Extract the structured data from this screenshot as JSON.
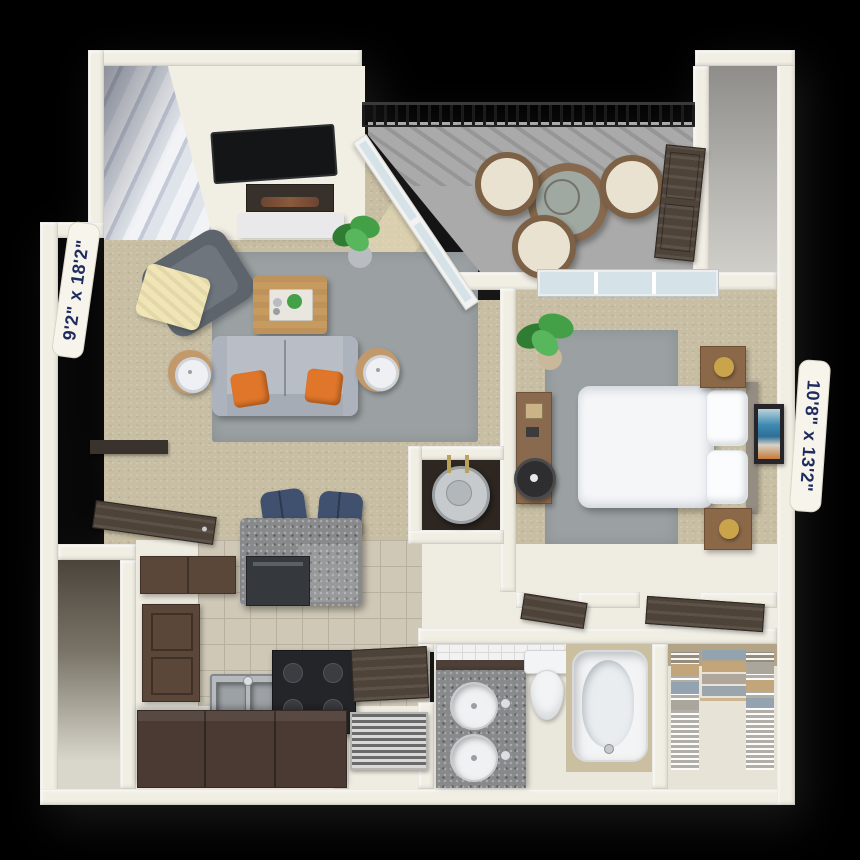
{
  "rooms": {
    "living_room": {
      "dimensions": "9'2\" x 18'2\"",
      "features": [
        "staircase",
        "tv",
        "fireplace",
        "hearth",
        "armchair",
        "throw-blanket",
        "sofa",
        "accent-pillows",
        "coffee-table",
        "serving-tray",
        "side-tables",
        "lamps",
        "area-rug",
        "potted-plant",
        "sliding-glass-door",
        "sunlight-patches"
      ]
    },
    "balcony": {
      "features": [
        "metal-railing",
        "wicker-bistro-table",
        "wicker-chairs",
        "storage-closet",
        "storage-doors"
      ]
    },
    "bedroom": {
      "dimensions": "10'8\" x 13'2\"",
      "features": [
        "bed",
        "white-duvet",
        "pillows",
        "headboard",
        "nightstands",
        "gold-lamps",
        "desk",
        "desk-chair",
        "area-rug",
        "potted-plant",
        "wall-art",
        "window",
        "open-doors"
      ]
    },
    "kitchen": {
      "features": [
        "breakfast-bar",
        "bar-stools",
        "dishwasher",
        "double-sink",
        "range",
        "upper-cabinet",
        "pantry-door",
        "base-counters",
        "tile-floor",
        "entry-door"
      ]
    },
    "bathroom": {
      "features": [
        "granite-double-vanity",
        "round-sinks",
        "toilet",
        "bathtub",
        "tile-wainscot",
        "open-door"
      ]
    },
    "walk_in_closet": {
      "features": [
        "wire-shelving",
        "folded-clothes"
      ]
    },
    "utility": {
      "features": [
        "water-heater",
        "laundry-closet",
        "hvac-vent-panel"
      ]
    }
  },
  "colors": {
    "background": "#000000",
    "wall": "#f1eee4",
    "wall_shade": "#dedacb",
    "carpet": "#c8bea3",
    "rug": "#9ba1a3",
    "sunlight": "#e9dfba",
    "balcony_floor": "#aaaaaa",
    "storage_floor": "#b4b3af",
    "railing": "#1b1b1b",
    "glass": "#d5e3e9",
    "window_frame": "#ededed",
    "sofa": "#b9bec6",
    "sofa_shade": "#a5acb6",
    "armchair": "#5d646c",
    "throw_blanket": "#f1e5b5",
    "pillow_accent": "#e0762a",
    "wood": "#c79a60",
    "side_table": "#c2996b",
    "lamp_white": "#eef0f3",
    "plant_green": "#43a047",
    "plant_dark": "#2e7d32",
    "plant_pot": "#b9bdc2",
    "tile": "#cfc8b7",
    "grout": "#b8b1a0",
    "granite": "#87898b",
    "granite_dark": "#5f6164",
    "stool_blue": "#3f516f",
    "cabinet_brown": "#5b463a",
    "counter_dark": "#4a3a33",
    "stove_black": "#232528",
    "steel": "#b6babd",
    "door_dark": "#4e4339",
    "bed_white": "#f5f6f8",
    "pillow_white": "#fbfcfd",
    "headboard": "#948d82",
    "nightstand": "#8a6848",
    "lamp_gold": "#c9a44a",
    "art_blue": "#3e8ab2",
    "art_orange": "#c77a38",
    "tub_surround": "#cbbfa2",
    "porcelain": "#f3f4f5",
    "heater_gray": "#c6cacd",
    "wire_shelf": "#cfcfcf",
    "clothes_tan": "#c2a57a",
    "clothes_blue": "#93a3b0",
    "clothes_gray": "#aba69c",
    "label_bg": "#f7f4eb",
    "label_text": "#1e2b5e",
    "utility_dark": "#57524a",
    "corridor": "#efece2",
    "dark_floor": "#2e2620"
  }
}
